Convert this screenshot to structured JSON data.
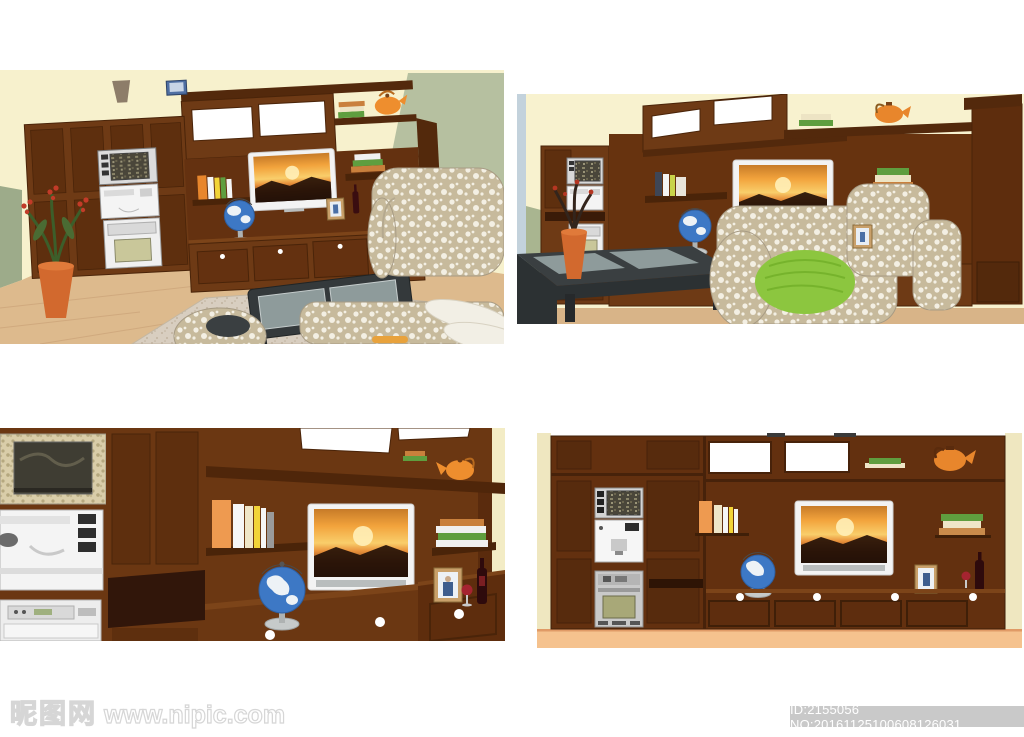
{
  "page": {
    "width": 1024,
    "height": 737,
    "background": "#ffffff"
  },
  "watermarks": {
    "site_logo": "昵图网",
    "site_url": "www.nipic.com",
    "id_label": "ID:2155056 NO:20161125100608126031"
  },
  "panels": [
    {
      "name": "render-perspective-room",
      "alt": "3D living room, brown wall unit with TV, sofa set, coffee table, plant"
    },
    {
      "name": "render-close-perspective",
      "alt": "Closer 3D view of wall unit with TV, sofa with green cushion, coffee table"
    },
    {
      "name": "render-detail-view",
      "alt": "Close-up of wall unit: appliances, books, TV, globe, wine and frame"
    },
    {
      "name": "render-front-elevation",
      "alt": "Flat front elevation of the brown wall unit"
    }
  ],
  "scene_objects": [
    "wall-unit",
    "tv-sunset",
    "globe",
    "books",
    "teapot",
    "wine-bottle",
    "wine-glass",
    "picture-frame",
    "microwave",
    "oven",
    "sofa",
    "armchair",
    "coffee-table",
    "rug",
    "potted-plant",
    "vase"
  ],
  "colors": {
    "cabinet_brown": "#6E3A15",
    "cabinet_dark": "#4A2409",
    "wall_cream": "#F7F1CD",
    "wall_sage": "#B6C0A0",
    "floor_wood": "#DDBA8D",
    "floor_peach": "#F5C28E",
    "sofa_beige": "#C7BA9C",
    "cushion_green": "#8CC63F",
    "globe_blue": "#3D78C5",
    "teapot_orange": "#E8862C",
    "table_charcoal": "#34393B",
    "id_bar_gray": "#C9C9C9"
  }
}
